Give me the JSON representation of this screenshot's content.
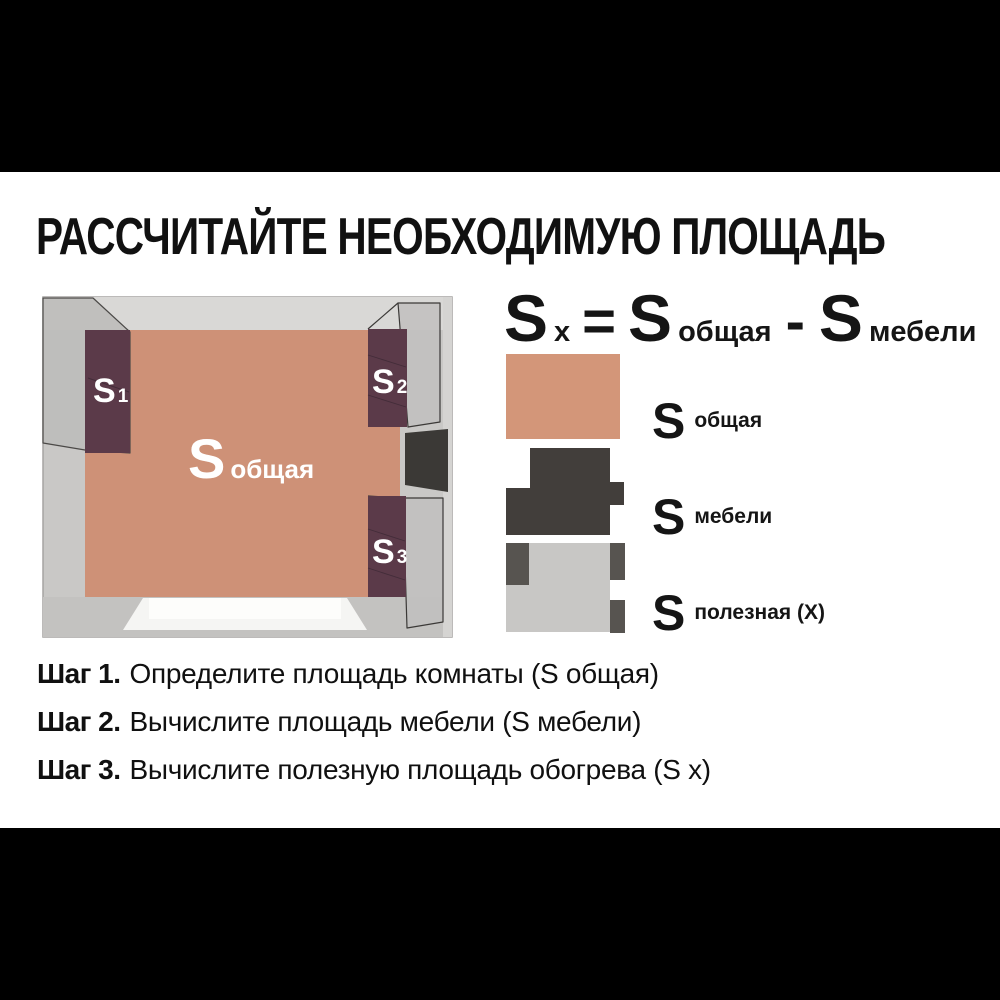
{
  "title": "РАССЧИТАЙТЕ НЕОБХОДИМУЮ ПЛОЩАДЬ",
  "formula": {
    "sx_base": "S",
    "sx_sub": "x",
    "equals": "=",
    "total_base": "S",
    "total_sub": "общая",
    "minus": "-",
    "furniture_base": "S",
    "furniture_sub": "мебели"
  },
  "room": {
    "floor_label": {
      "base": "S",
      "sub": "общая"
    },
    "furniture_labels": [
      {
        "base": "S",
        "sub": "1"
      },
      {
        "base": "S",
        "sub": "2"
      },
      {
        "base": "S",
        "sub": "3"
      }
    ]
  },
  "legend": {
    "items": [
      {
        "base": "S",
        "label": "общая"
      },
      {
        "base": "S",
        "label": "мебели"
      },
      {
        "base": "S",
        "label": "полезная (X)"
      }
    ]
  },
  "steps": [
    {
      "label": "Шаг 1.",
      "text": "Определите площадь комнаты (S общая)"
    },
    {
      "label": "Шаг 2.",
      "text": "Вычислите площадь мебели (S мебели)"
    },
    {
      "label": "Шаг 3.",
      "text": "Вычислите полезную площадь обогрева (S x)"
    }
  ],
  "colors": {
    "floor_total": "#CE9177",
    "swatch_total": "#D39679",
    "furniture_plum": "#5B3A49",
    "swatch_furniture_dark": "#423E3B",
    "swatch_useful_light": "#C8C7C5",
    "swatch_block_dark": "#575450",
    "wall_gray": "#C9C8C6",
    "door_dark": "#3B3936",
    "text_black": "#111111",
    "background": "#FFFFFF",
    "letterbox": "#000000"
  }
}
